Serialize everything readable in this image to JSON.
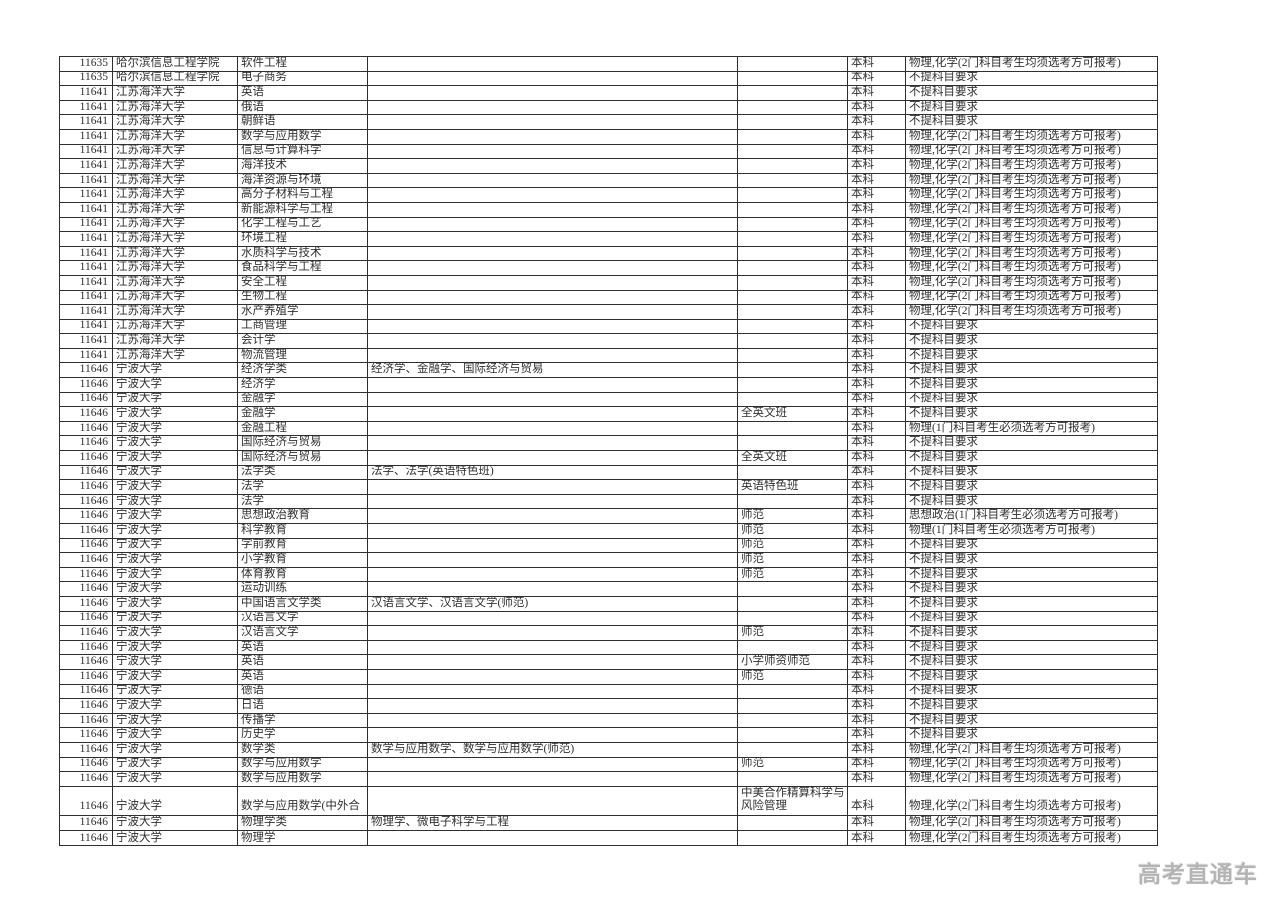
{
  "colors": {
    "grid_line": "#2f2f2f",
    "table_text": "#303030",
    "watermark_text": "#b4b4b4",
    "background": "#ffffff"
  },
  "watermark": {
    "text": "高考直通车"
  },
  "table": {
    "columns": [
      {
        "key": "code"
      },
      {
        "key": "university"
      },
      {
        "key": "major"
      },
      {
        "key": "included"
      },
      {
        "key": "remark"
      },
      {
        "key": "level"
      },
      {
        "key": "requirement"
      }
    ],
    "rows": [
      {
        "code": "11635",
        "university": "哈尔滨信息工程学院",
        "major": "软件工程",
        "included": "",
        "remark": "",
        "level": "本科",
        "requirement": "物理,化学(2门科目考生均须选考方可报考)"
      },
      {
        "code": "11635",
        "university": "哈尔滨信息工程学院",
        "major": "电子商务",
        "included": "",
        "remark": "",
        "level": "本科",
        "requirement": "不提科目要求"
      },
      {
        "code": "11641",
        "university": "江苏海洋大学",
        "major": "英语",
        "included": "",
        "remark": "",
        "level": "本科",
        "requirement": "不提科目要求"
      },
      {
        "code": "11641",
        "university": "江苏海洋大学",
        "major": "俄语",
        "included": "",
        "remark": "",
        "level": "本科",
        "requirement": "不提科目要求"
      },
      {
        "code": "11641",
        "university": "江苏海洋大学",
        "major": "朝鲜语",
        "included": "",
        "remark": "",
        "level": "本科",
        "requirement": "不提科目要求"
      },
      {
        "code": "11641",
        "university": "江苏海洋大学",
        "major": "数学与应用数学",
        "included": "",
        "remark": "",
        "level": "本科",
        "requirement": "物理,化学(2门科目考生均须选考方可报考)"
      },
      {
        "code": "11641",
        "university": "江苏海洋大学",
        "major": "信息与计算科学",
        "included": "",
        "remark": "",
        "level": "本科",
        "requirement": "物理,化学(2门科目考生均须选考方可报考)"
      },
      {
        "code": "11641",
        "university": "江苏海洋大学",
        "major": "海洋技术",
        "included": "",
        "remark": "",
        "level": "本科",
        "requirement": "物理,化学(2门科目考生均须选考方可报考)"
      },
      {
        "code": "11641",
        "university": "江苏海洋大学",
        "major": "海洋资源与环境",
        "included": "",
        "remark": "",
        "level": "本科",
        "requirement": "物理,化学(2门科目考生均须选考方可报考)"
      },
      {
        "code": "11641",
        "university": "江苏海洋大学",
        "major": "高分子材料与工程",
        "included": "",
        "remark": "",
        "level": "本科",
        "requirement": "物理,化学(2门科目考生均须选考方可报考)"
      },
      {
        "code": "11641",
        "university": "江苏海洋大学",
        "major": "新能源科学与工程",
        "included": "",
        "remark": "",
        "level": "本科",
        "requirement": "物理,化学(2门科目考生均须选考方可报考)"
      },
      {
        "code": "11641",
        "university": "江苏海洋大学",
        "major": "化学工程与工艺",
        "included": "",
        "remark": "",
        "level": "本科",
        "requirement": "物理,化学(2门科目考生均须选考方可报考)"
      },
      {
        "code": "11641",
        "university": "江苏海洋大学",
        "major": "环境工程",
        "included": "",
        "remark": "",
        "level": "本科",
        "requirement": "物理,化学(2门科目考生均须选考方可报考)"
      },
      {
        "code": "11641",
        "university": "江苏海洋大学",
        "major": "水质科学与技术",
        "included": "",
        "remark": "",
        "level": "本科",
        "requirement": "物理,化学(2门科目考生均须选考方可报考)"
      },
      {
        "code": "11641",
        "university": "江苏海洋大学",
        "major": "食品科学与工程",
        "included": "",
        "remark": "",
        "level": "本科",
        "requirement": "物理,化学(2门科目考生均须选考方可报考)"
      },
      {
        "code": "11641",
        "university": "江苏海洋大学",
        "major": "安全工程",
        "included": "",
        "remark": "",
        "level": "本科",
        "requirement": "物理,化学(2门科目考生均须选考方可报考)"
      },
      {
        "code": "11641",
        "university": "江苏海洋大学",
        "major": "生物工程",
        "included": "",
        "remark": "",
        "level": "本科",
        "requirement": "物理,化学(2门科目考生均须选考方可报考)"
      },
      {
        "code": "11641",
        "university": "江苏海洋大学",
        "major": "水产养殖学",
        "included": "",
        "remark": "",
        "level": "本科",
        "requirement": "物理,化学(2门科目考生均须选考方可报考)"
      },
      {
        "code": "11641",
        "university": "江苏海洋大学",
        "major": "工商管理",
        "included": "",
        "remark": "",
        "level": "本科",
        "requirement": "不提科目要求"
      },
      {
        "code": "11641",
        "university": "江苏海洋大学",
        "major": "会计学",
        "included": "",
        "remark": "",
        "level": "本科",
        "requirement": "不提科目要求"
      },
      {
        "code": "11641",
        "university": "江苏海洋大学",
        "major": "物流管理",
        "included": "",
        "remark": "",
        "level": "本科",
        "requirement": "不提科目要求"
      },
      {
        "code": "11646",
        "university": "宁波大学",
        "major": "经济学类",
        "included": "经济学、金融学、国际经济与贸易",
        "remark": "",
        "level": "本科",
        "requirement": "不提科目要求"
      },
      {
        "code": "11646",
        "university": "宁波大学",
        "major": "经济学",
        "included": "",
        "remark": "",
        "level": "本科",
        "requirement": "不提科目要求"
      },
      {
        "code": "11646",
        "university": "宁波大学",
        "major": "金融学",
        "included": "",
        "remark": "",
        "level": "本科",
        "requirement": "不提科目要求"
      },
      {
        "code": "11646",
        "university": "宁波大学",
        "major": "金融学",
        "included": "",
        "remark": "全英文班",
        "level": "本科",
        "requirement": "不提科目要求"
      },
      {
        "code": "11646",
        "university": "宁波大学",
        "major": "金融工程",
        "included": "",
        "remark": "",
        "level": "本科",
        "requirement": "物理(1门科目考生必须选考方可报考)"
      },
      {
        "code": "11646",
        "university": "宁波大学",
        "major": "国际经济与贸易",
        "included": "",
        "remark": "",
        "level": "本科",
        "requirement": "不提科目要求"
      },
      {
        "code": "11646",
        "university": "宁波大学",
        "major": "国际经济与贸易",
        "included": "",
        "remark": "全英文班",
        "level": "本科",
        "requirement": "不提科目要求"
      },
      {
        "code": "11646",
        "university": "宁波大学",
        "major": "法学类",
        "included": "法学、法学(英语特色班)",
        "remark": "",
        "level": "本科",
        "requirement": "不提科目要求"
      },
      {
        "code": "11646",
        "university": "宁波大学",
        "major": "法学",
        "included": "",
        "remark": "英语特色班",
        "level": "本科",
        "requirement": "不提科目要求"
      },
      {
        "code": "11646",
        "university": "宁波大学",
        "major": "法学",
        "included": "",
        "remark": "",
        "level": "本科",
        "requirement": "不提科目要求"
      },
      {
        "code": "11646",
        "university": "宁波大学",
        "major": "思想政治教育",
        "included": "",
        "remark": "师范",
        "level": "本科",
        "requirement": "思想政治(1门科目考生必须选考方可报考)"
      },
      {
        "code": "11646",
        "university": "宁波大学",
        "major": "科学教育",
        "included": "",
        "remark": "师范",
        "level": "本科",
        "requirement": "物理(1门科目考生必须选考方可报考)"
      },
      {
        "code": "11646",
        "university": "宁波大学",
        "major": "学前教育",
        "included": "",
        "remark": "师范",
        "level": "本科",
        "requirement": "不提科目要求"
      },
      {
        "code": "11646",
        "university": "宁波大学",
        "major": "小学教育",
        "included": "",
        "remark": "师范",
        "level": "本科",
        "requirement": "不提科目要求"
      },
      {
        "code": "11646",
        "university": "宁波大学",
        "major": "体育教育",
        "included": "",
        "remark": "师范",
        "level": "本科",
        "requirement": "不提科目要求"
      },
      {
        "code": "11646",
        "university": "宁波大学",
        "major": "运动训练",
        "included": "",
        "remark": "",
        "level": "本科",
        "requirement": "不提科目要求"
      },
      {
        "code": "11646",
        "university": "宁波大学",
        "major": "中国语言文学类",
        "included": "汉语言文学、汉语言文学(师范)",
        "remark": "",
        "level": "本科",
        "requirement": "不提科目要求"
      },
      {
        "code": "11646",
        "university": "宁波大学",
        "major": "汉语言文学",
        "included": "",
        "remark": "",
        "level": "本科",
        "requirement": "不提科目要求"
      },
      {
        "code": "11646",
        "university": "宁波大学",
        "major": "汉语言文学",
        "included": "",
        "remark": "师范",
        "level": "本科",
        "requirement": "不提科目要求"
      },
      {
        "code": "11646",
        "university": "宁波大学",
        "major": "英语",
        "included": "",
        "remark": "",
        "level": "本科",
        "requirement": "不提科目要求"
      },
      {
        "code": "11646",
        "university": "宁波大学",
        "major": "英语",
        "included": "",
        "remark": "小学师资师范",
        "level": "本科",
        "requirement": "不提科目要求"
      },
      {
        "code": "11646",
        "university": "宁波大学",
        "major": "英语",
        "included": "",
        "remark": "师范",
        "level": "本科",
        "requirement": "不提科目要求"
      },
      {
        "code": "11646",
        "university": "宁波大学",
        "major": "德语",
        "included": "",
        "remark": "",
        "level": "本科",
        "requirement": "不提科目要求"
      },
      {
        "code": "11646",
        "university": "宁波大学",
        "major": "日语",
        "included": "",
        "remark": "",
        "level": "本科",
        "requirement": "不提科目要求"
      },
      {
        "code": "11646",
        "university": "宁波大学",
        "major": "传播学",
        "included": "",
        "remark": "",
        "level": "本科",
        "requirement": "不提科目要求"
      },
      {
        "code": "11646",
        "university": "宁波大学",
        "major": "历史学",
        "included": "",
        "remark": "",
        "level": "本科",
        "requirement": "不提科目要求"
      },
      {
        "code": "11646",
        "university": "宁波大学",
        "major": "数学类",
        "included": "数学与应用数学、数学与应用数学(师范)",
        "remark": "",
        "level": "本科",
        "requirement": "物理,化学(2门科目考生均须选考方可报考)"
      },
      {
        "code": "11646",
        "university": "宁波大学",
        "major": "数学与应用数学",
        "included": "",
        "remark": "师范",
        "level": "本科",
        "requirement": "物理,化学(2门科目考生均须选考方可报考)"
      },
      {
        "code": "11646",
        "university": "宁波大学",
        "major": "数学与应用数学",
        "included": "",
        "remark": "",
        "level": "本科",
        "requirement": "物理,化学(2门科目考生均须选考方可报考)"
      },
      {
        "code": "11646",
        "university": "宁波大学",
        "major": "数学与应用数学(中外合",
        "included": "",
        "remark": "中美合作精算科学与风险管理",
        "level": "本科",
        "requirement": "物理,化学(2门科目考生均须选考方可报考)",
        "tall": true
      },
      {
        "code": "11646",
        "university": "宁波大学",
        "major": "物理学类",
        "included": "物理学、微电子科学与工程",
        "remark": "",
        "level": "本科",
        "requirement": "物理,化学(2门科目考生均须选考方可报考)"
      },
      {
        "code": "11646",
        "university": "宁波大学",
        "major": "物理学",
        "included": "",
        "remark": "",
        "level": "本科",
        "requirement": "物理,化学(2门科目考生均须选考方可报考)"
      }
    ]
  }
}
